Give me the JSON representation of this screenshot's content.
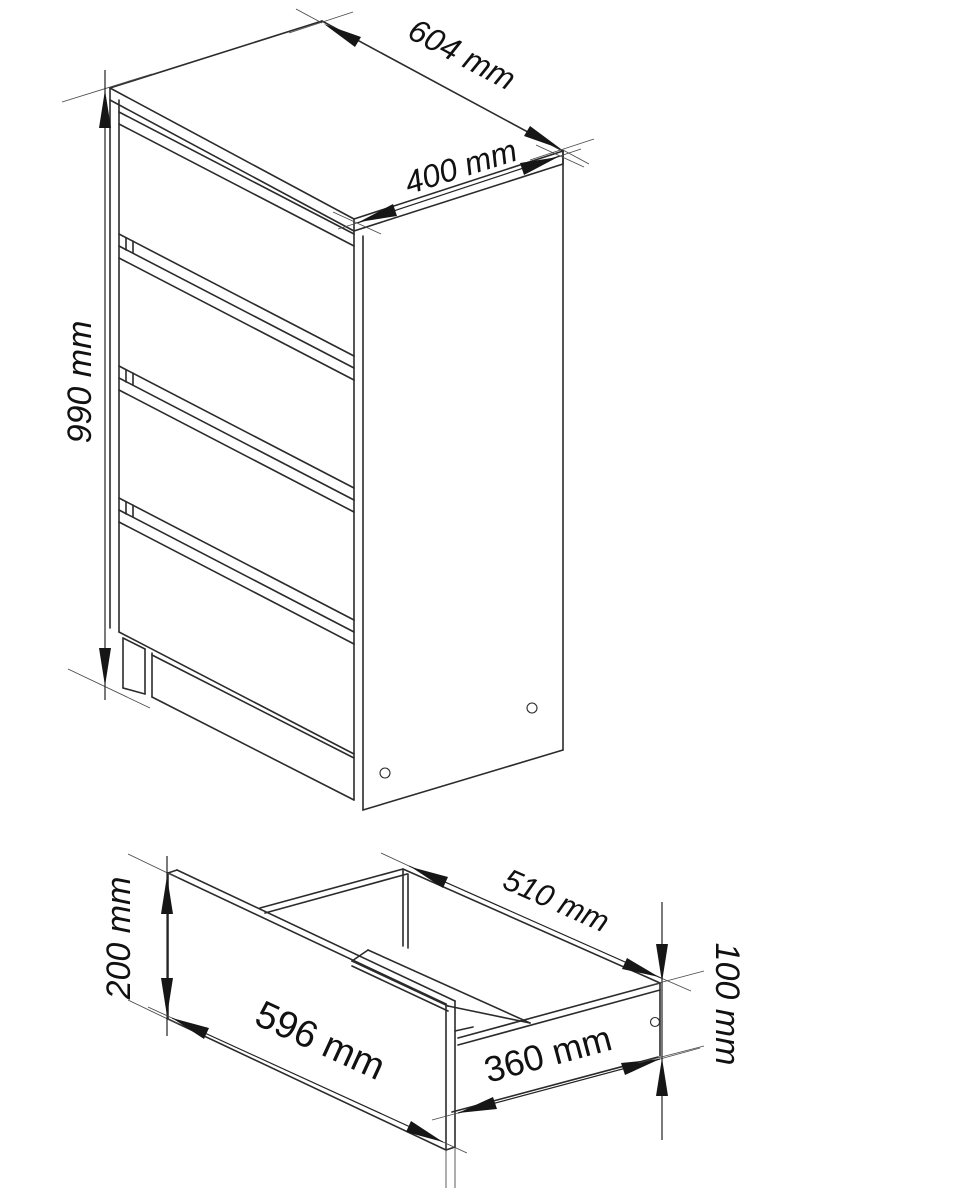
{
  "document": {
    "kind": "furniture-dimension-drawing",
    "background": "#ffffff",
    "line_color": "#2b2b2b",
    "text_color": "#111111"
  },
  "figures": {
    "dresser": {
      "name": "chest-of-drawers-isometric",
      "drawer_count": 4,
      "dims": {
        "width": "604 mm",
        "depth": "400 mm",
        "height": "990 mm"
      }
    },
    "drawer": {
      "name": "single-drawer-isometric",
      "dims": {
        "front_height": "200 mm",
        "front_width": "596 mm",
        "back_width": "510 mm",
        "side_depth": "360 mm",
        "side_height": "100 mm"
      }
    }
  }
}
